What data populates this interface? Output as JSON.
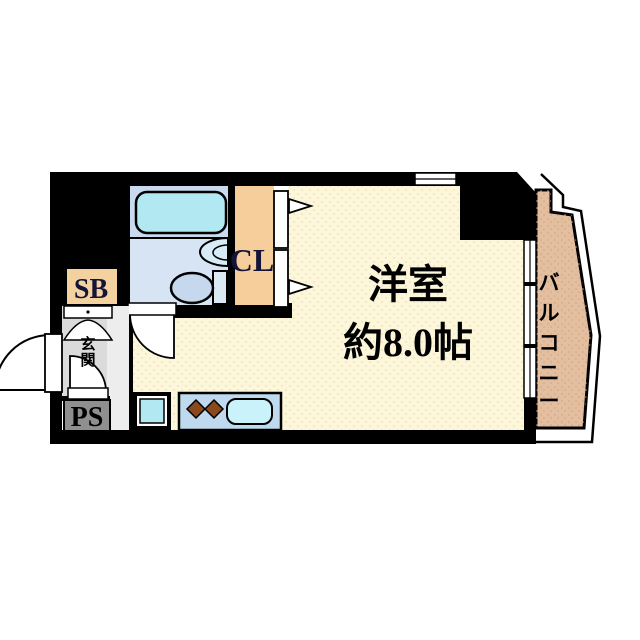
{
  "floorplan": {
    "labels": {
      "room_name": "洋室",
      "room_size": "約8.0帖",
      "balcony": "バルコニー",
      "closet": "CL",
      "shoe_box": "SB",
      "pipe_space": "PS",
      "entrance": "玄関"
    },
    "icons": {
      "bathtub": "bathtub-icon",
      "toilet": "toilet-icon",
      "washbasin": "washbasin-icon",
      "kitchen_sink": "kitchen-sink-icon",
      "stove_burners": "stove-burner-icon",
      "door_swing": "door-swing-icon",
      "double_door_arrows": "door-open-arrow-icon",
      "window": "window-icon"
    },
    "colors": {
      "wall": "#000000",
      "room_floor": "#FBF7D8",
      "balcony_floor": "#E3BFA0",
      "closet_floor": "#F5CE9B",
      "shoe_box_bg": "#F3D2A0",
      "bathroom_upper": "#C9DAEE",
      "bathroom_lower": "#D6E4F4",
      "bathtub": "#B2E8F2",
      "toilet_bowl": "#C6D8EE",
      "toilet_tank": "#DCE8F4",
      "basin": "#D8ECF8",
      "kitchen_counter": "#BFDAEE",
      "kitchen_sink": "#C9F2FB",
      "appliance": "#B2E8F2",
      "entrance_floor": "#DBDBDB",
      "hall_floor": "#EDEDED",
      "pipe_space_bg": "#8F8F8F",
      "burner": "#8B4A1E",
      "label_dark": "#141438",
      "text": "#000000"
    }
  }
}
